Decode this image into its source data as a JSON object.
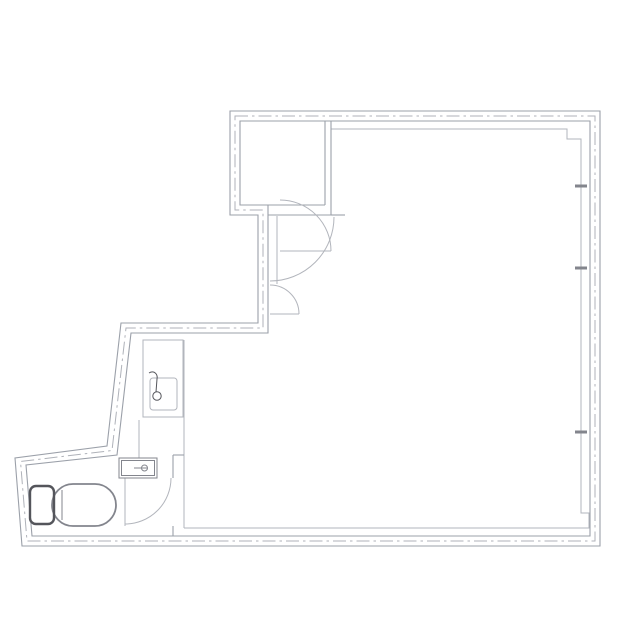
{
  "document": {
    "kind": "architectural floor plan (scanned drawing)",
    "language": "ja"
  },
  "labels": {
    "closet": "収納"
  },
  "fixtures": [
    "closet",
    "entry-swing-door",
    "closet-swing-door",
    "small-swing-door",
    "vanity-counter",
    "vanity-sink",
    "faucet",
    "hand-wash-basin",
    "toilet",
    "toilet-swing-door",
    "window-mullion-ticks"
  ],
  "colors": {
    "background": "#ffffff",
    "wall_line": "#9ba0a9",
    "light_line": "#b2b5bc",
    "centerline": "#afb2b9",
    "fixture_mid": "#83858d",
    "fixture_dark": "#54555b",
    "label_text": "#3f4046"
  }
}
